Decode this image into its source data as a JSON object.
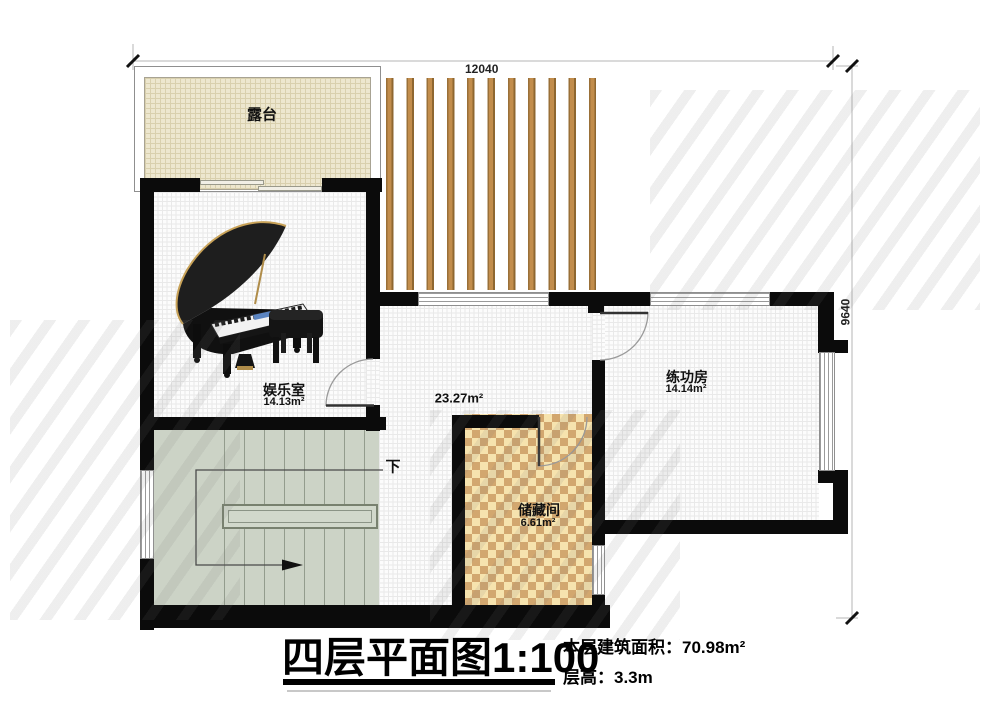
{
  "plan": {
    "title": "四层平面图1:100",
    "stats": {
      "building_area": "本层建筑面积：70.98m²",
      "floor_height": "层高：3.3m"
    },
    "dimensions": {
      "top": "12040",
      "right": "9640"
    },
    "rooms": {
      "terrace": {
        "name": "露台"
      },
      "entertainment": {
        "name": "娱乐室",
        "area": "14.13m²"
      },
      "hall": {
        "area": "23.27m²"
      },
      "practice": {
        "name": "练功房",
        "area": "14.14m²"
      },
      "storage": {
        "name": "储藏间",
        "area": "6.61m²"
      },
      "stairs": {
        "down": "下"
      }
    },
    "colors": {
      "wall": "#0b0b0b",
      "slat_wood": "#c28d4c",
      "stairs_fill": "#ccd3c6",
      "checker_tan": "#d2a76f",
      "checker_cream": "#f6e3ae",
      "terrace_fill": "#ede7cf"
    }
  }
}
